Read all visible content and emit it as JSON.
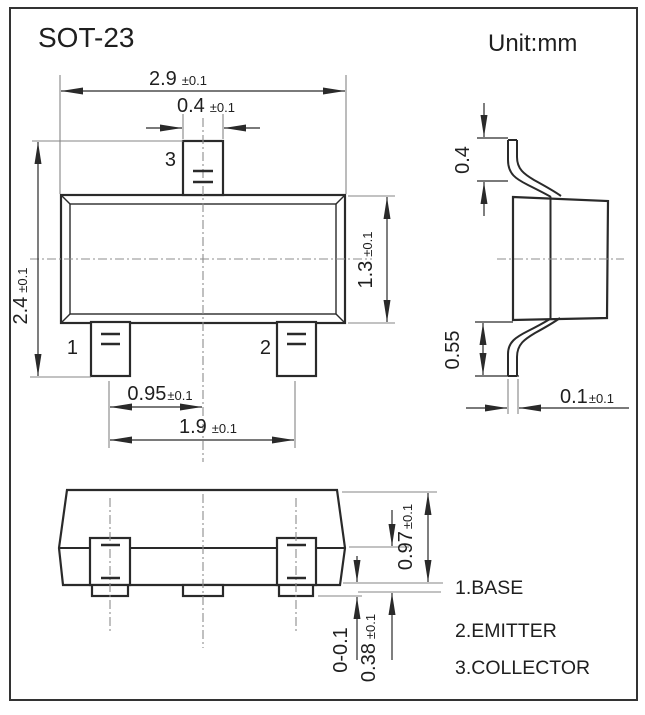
{
  "title": "SOT-23",
  "unit_label": "Unit:mm",
  "top_view": {
    "pin_labels": {
      "pin1": "1",
      "pin2": "2",
      "pin3": "3"
    },
    "dims": {
      "overall_width": {
        "value": "2.9",
        "tol": "±0.1"
      },
      "lead_width": {
        "value": "0.4",
        "tol": "±0.1"
      },
      "overall_height": {
        "value": "2.4",
        "tol": "±0.1"
      },
      "body_height": {
        "value": "1.3",
        "tol": "±0.1"
      },
      "lead_pitch_half": {
        "value": "0.95",
        "tol": "±0.1"
      },
      "lead_pitch": {
        "value": "1.9",
        "tol": "±0.1"
      }
    }
  },
  "side_view": {
    "dims": {
      "upper_lead_height": {
        "value": "0.4",
        "tol": ""
      },
      "lower_lead_height": {
        "value": "0.55",
        "tol": ""
      },
      "lead_thickness": {
        "value": "0.1",
        "tol": "±0.1"
      }
    }
  },
  "front_view": {
    "dims": {
      "total_height": {
        "value": "0.97",
        "tol": "±0.1"
      },
      "standoff": {
        "value": "0-0.1",
        "tol": ""
      },
      "lead_height": {
        "value": "0.38",
        "tol": "±0.1"
      }
    }
  },
  "legend": [
    "1.BASE",
    "2.EMITTER",
    "3.COLLECTOR"
  ],
  "colors": {
    "line": "#2a2a2a",
    "centerline": "#8c8c8c",
    "extension": "#858585",
    "text": "#1f1f1f",
    "background": "#ffffff"
  }
}
